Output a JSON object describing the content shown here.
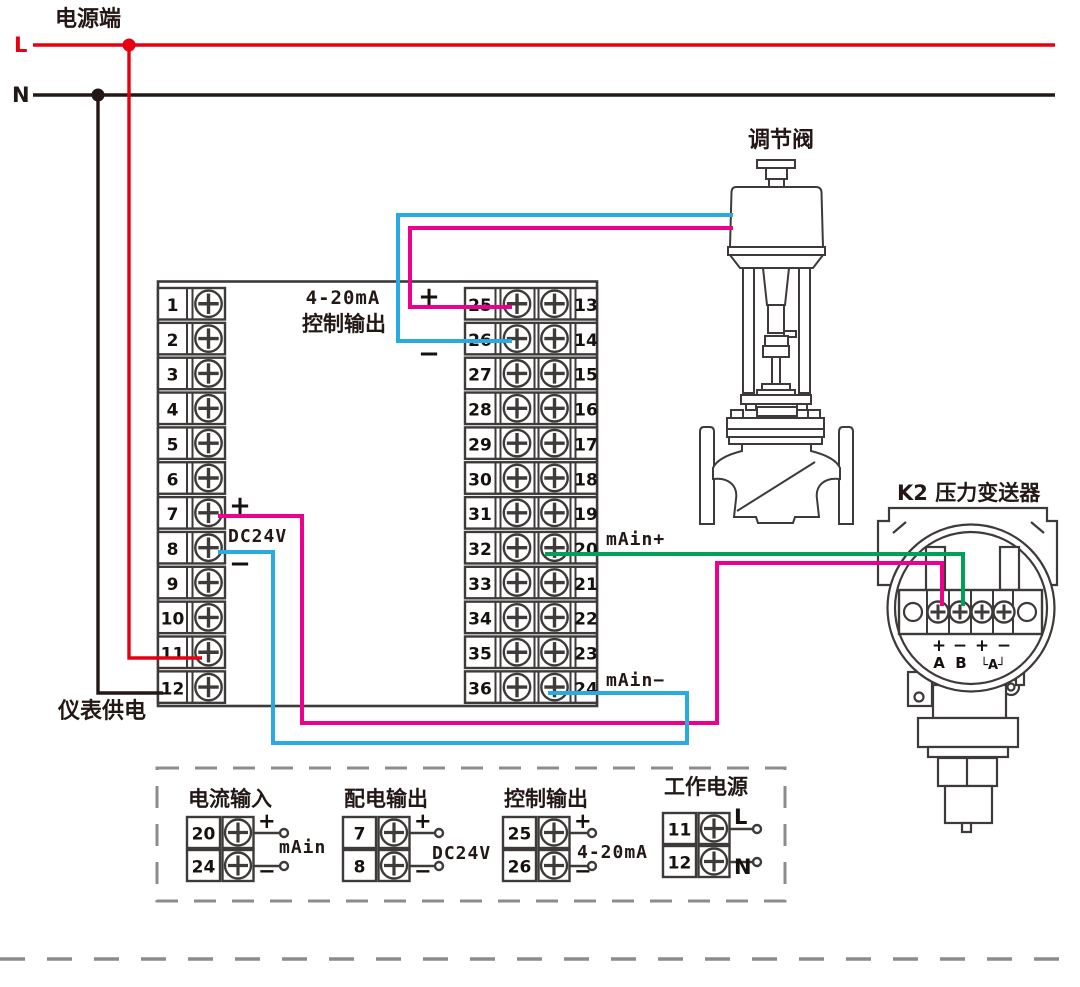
{
  "power": {
    "terminal_label": "电源端",
    "line_l": "L",
    "line_n": "N"
  },
  "instrument": {
    "left_terminals": [
      "1",
      "2",
      "3",
      "4",
      "5",
      "6",
      "7",
      "8",
      "9",
      "10",
      "11",
      "12"
    ],
    "mid_left_terminals": [
      "25",
      "26",
      "27",
      "28",
      "29",
      "30",
      "31",
      "32",
      "33",
      "34",
      "35",
      "36"
    ],
    "mid_right_terminals": [
      "13",
      "14",
      "15",
      "16",
      "17",
      "18",
      "19",
      "20",
      "21",
      "22",
      "23",
      "24"
    ],
    "output_label_line1": "4-20mA",
    "output_label_line2": "控制输出",
    "output_plus": "+",
    "output_minus": "−",
    "power_plus": "+",
    "power_voltage": "DC24V",
    "power_minus": "−",
    "supply_label": "仪表供电"
  },
  "signals": {
    "input_plus": "mAin+",
    "input_minus": "mAin−"
  },
  "valve": {
    "label": "调节阀"
  },
  "transmitter": {
    "label": "K2 压力变送器",
    "signs": [
      "+",
      "−",
      "+",
      "−"
    ],
    "letters": [
      "A",
      "B"
    ],
    "group_label": "└A┘"
  },
  "legend": {
    "groups": [
      {
        "title": "电流输入",
        "rows": [
          {
            "terminal": "20",
            "sign": "+"
          },
          {
            "terminal": "24",
            "sign": "−"
          }
        ],
        "tag": "mAin"
      },
      {
        "title": "配电输出",
        "rows": [
          {
            "terminal": "7",
            "sign": "+"
          },
          {
            "terminal": "8",
            "sign": "−"
          }
        ],
        "tag": "DC24V"
      },
      {
        "title": "控制输出",
        "rows": [
          {
            "terminal": "25",
            "sign": "+"
          },
          {
            "terminal": "26",
            "sign": "−"
          }
        ],
        "tag": "4-20mA"
      },
      {
        "title": "工作电源",
        "rows": [
          {
            "terminal": "11",
            "sign": "L"
          },
          {
            "terminal": "12",
            "sign": "N"
          }
        ],
        "tag": ""
      }
    ]
  },
  "colors": {
    "wire_live": "#e60012",
    "wire_neutral": "#231815",
    "wire_magenta": "#ec008c",
    "wire_cyan": "#29abe2",
    "wire_green": "#00a059",
    "line_art": "#3e3a39",
    "dash_gray": "#8c8c8c",
    "text": "#231815"
  }
}
